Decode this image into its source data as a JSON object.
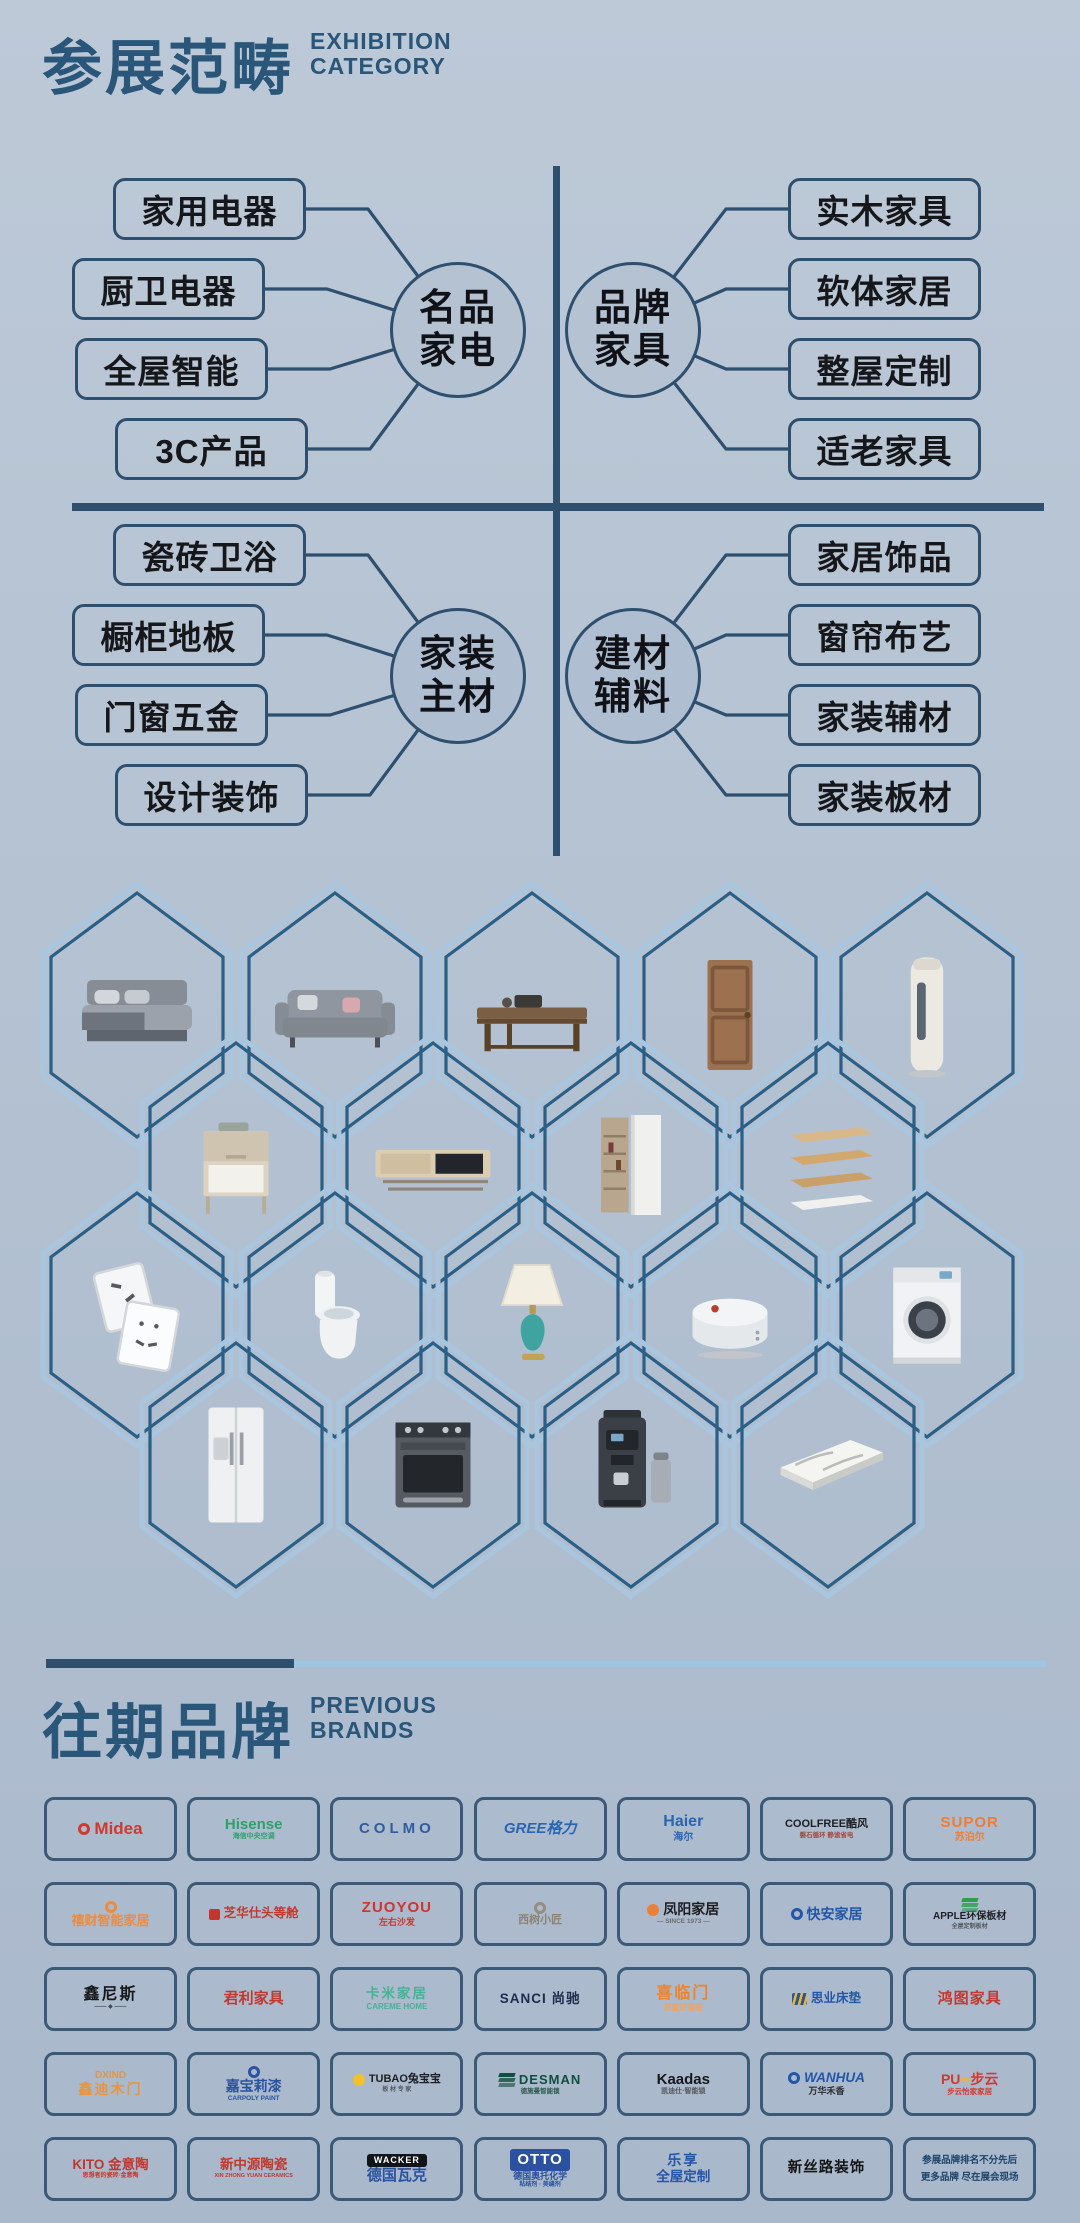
{
  "theme": {
    "accent_title": "#2a567a",
    "accent_line": "#2e4f6e",
    "hex_border_outer": "#a9c6de",
    "hex_border_inner": "#2a5f87",
    "divider_light": "#9fc6e0"
  },
  "header": {
    "title_cn": "参展范畴",
    "title_en_line1": "EXHIBITION",
    "title_en_line2": "CATEGORY"
  },
  "category_map": {
    "quadrants": [
      {
        "circle_line1": "名品",
        "circle_line2": "家电",
        "items": [
          "家用电器",
          "厨卫电器",
          "全屋智能",
          "3C产品"
        ]
      },
      {
        "circle_line1": "品牌",
        "circle_line2": "家具",
        "items": [
          "实木家具",
          "软体家居",
          "整屋定制",
          "适老家具"
        ]
      },
      {
        "circle_line1": "家装",
        "circle_line2": "主材",
        "items": [
          "瓷砖卫浴",
          "橱柜地板",
          "门窗五金",
          "设计装饰"
        ]
      },
      {
        "circle_line1": "建材",
        "circle_line2": "辅料",
        "items": [
          "家居饰品",
          "窗帘布艺",
          "家装辅材",
          "家装板材"
        ]
      }
    ]
  },
  "hex_products": {
    "rows": [
      [
        "bed",
        "sofa",
        "coffee-table",
        "wooden-door",
        "floor-ac"
      ],
      [
        "nightstand",
        "tv-cabinet",
        "wardrobe",
        "wall-shelves"
      ],
      [
        "switch-sockets",
        "toilet",
        "table-lamp",
        "robot-vacuum",
        "washing-machine"
      ],
      [
        "refrigerator",
        "oven",
        "coffee-machine",
        "stone-slab"
      ]
    ]
  },
  "brands_header": {
    "title_cn": "往期品牌",
    "title_en_line1": "PREVIOUS",
    "title_en_line2": "BRANDS"
  },
  "brands": {
    "rows": [
      [
        {
          "n": "brand-midea",
          "main": "Midea",
          "mc": "#cf3a30",
          "ms": 17,
          "mark": {
            "shape": "ring",
            "color": "#cf3a30"
          }
        },
        {
          "n": "brand-hisense",
          "main": "Hisense",
          "mc": "#2ea06b",
          "ms": 15,
          "sub": "海信中央空调",
          "sc": "#2ea06b",
          "ss": 7
        },
        {
          "n": "brand-colmo",
          "main": "COLMO",
          "mc": "#2f5d9e",
          "ms": 15,
          "sp": 4
        },
        {
          "n": "brand-gree",
          "main": "GREE格力",
          "mc": "#2a66b0",
          "ms": 15,
          "it": true
        },
        {
          "n": "brand-haier",
          "main": "Haier",
          "mc": "#2a66b0",
          "ms": 16,
          "sub": "海尔",
          "sc": "#2a66b0",
          "ss": 10
        },
        {
          "n": "brand-coolfree",
          "main": "COOLFREE酷风",
          "mc": "#1d1f24",
          "ms": 11,
          "sub": "磐石循环 静谧省电",
          "sc": "#a04a42",
          "ss": 6.5
        },
        {
          "n": "brand-supor",
          "main": "SUPOR",
          "mc": "#f07c32",
          "ms": 15,
          "sp": 1,
          "sub": "苏泊尔",
          "sc": "#f07c32",
          "ss": 10
        }
      ],
      [
        {
          "n": "brand-xicai",
          "main": "禧财智能家居",
          "mc": "#f08a3c",
          "ms": 13,
          "mark": {
            "shape": "ring",
            "color": "#f08a3c",
            "pos": "top"
          }
        },
        {
          "n": "brand-zhihuashi",
          "main": "芝华仕头等舱",
          "mc": "#bf3a30",
          "ms": 12.5,
          "mark": {
            "shape": "square",
            "color": "#c4352f"
          }
        },
        {
          "n": "brand-zuoyou",
          "main": "ZUOYOU",
          "mc": "#d0342c",
          "ms": 15,
          "sp": 1,
          "sub": "左右沙发",
          "sc": "#d0342c",
          "ss": 9
        },
        {
          "n": "brand-xishuxiaojiang",
          "main": "西树小匠",
          "mc": "#8b8475",
          "ms": 11,
          "mark": {
            "shape": "ring",
            "color": "#958d7f",
            "pos": "top"
          }
        },
        {
          "n": "brand-fengyang",
          "main": "凤阳家居",
          "mc": "#1d1d1f",
          "ms": 14,
          "mark": {
            "shape": "blob",
            "color": "#e8823a"
          },
          "sub": "— SINCE 1973 —",
          "sc": "#6b6b6b",
          "ss": 6.5
        },
        {
          "n": "brand-kuaian",
          "main": "快安家居",
          "mc": "#2456a8",
          "ms": 14,
          "mark": {
            "shape": "ring",
            "color": "#2456a8"
          }
        },
        {
          "n": "brand-apple-bancai",
          "main": "APPLE环保板材",
          "mc": "#1d1f24",
          "ms": 10,
          "mark": {
            "shape": "planks",
            "color": "#2e9e4f",
            "pos": "top"
          },
          "sub": "全屋定制板材",
          "sc": "#55585e",
          "ss": 6
        }
      ],
      [
        {
          "n": "brand-xinnisi",
          "main": "鑫尼斯",
          "mc": "#17181c",
          "ms": 16,
          "sp": 2,
          "sub": "—— ◆ ——",
          "sc": "#44474d",
          "ss": 6
        },
        {
          "n": "brand-junli",
          "main": "君利家具",
          "mc": "#c03a32",
          "ms": 15
        },
        {
          "n": "brand-kami",
          "main": "卡米家居",
          "mc": "#45b395",
          "ms": 13.5,
          "sp": 2,
          "sub": "CAREME HOME",
          "sc": "#45b395",
          "ss": 8
        },
        {
          "n": "brand-sanci",
          "main": "SANCI 尚驰",
          "mc": "#1f2c4d",
          "ms": 13.5,
          "sp": 1
        },
        {
          "n": "brand-xilinmen",
          "main": "喜临门",
          "mc": "#ef8329",
          "ms": 16,
          "sp": 2,
          "sub": "深度好睡眠",
          "sc": "#f2a45f",
          "ss": 8
        },
        {
          "n": "brand-siye",
          "main": "思业床垫",
          "mc": "#2456a8",
          "ms": 12.5,
          "mark": {
            "shape": "stripes",
            "color": "#2456a8"
          }
        },
        {
          "n": "brand-hongtu",
          "main": "鸿图家具",
          "mc": "#c03a32",
          "ms": 15,
          "sp": 1
        }
      ],
      [
        {
          "n": "brand-dxind",
          "top": "DXIND",
          "tc": "#e8953c",
          "ts": 10,
          "main": "鑫迪木门",
          "mc": "#e8953c",
          "ms": 14,
          "sp": 2
        },
        {
          "n": "brand-carpoly",
          "main": "嘉宝莉漆",
          "mc": "#2a52a0",
          "ms": 14,
          "mark": {
            "shape": "ring",
            "color": "#2a52a0",
            "pos": "top"
          },
          "sub": "CARPOLY PAINT",
          "sc": "#2a52a0",
          "ss": 6.5
        },
        {
          "n": "brand-tubao",
          "main": "TUBAO兔宝宝",
          "mc": "#1d1f24",
          "ms": 11,
          "mark": {
            "shape": "blob",
            "color": "#f2c12e"
          },
          "sub": "板 材 专 家",
          "sc": "#55585e",
          "ss": 6
        },
        {
          "n": "brand-desman",
          "main": "DESMAN",
          "mc": "#0e4f3e",
          "ms": 13,
          "sp": 1,
          "mark": {
            "shape": "planks",
            "color": "#0e4f3e"
          },
          "sub": "德施曼智能锁",
          "sc": "#2f5a4e",
          "ss": 6.5
        },
        {
          "n": "brand-kaadas",
          "main": "Kaadas",
          "mc": "#17181c",
          "ms": 15,
          "sub": "凯迪仕·智能锁",
          "sc": "#55585e",
          "ss": 7
        },
        {
          "n": "brand-wanhua",
          "main": "WANHUA",
          "mc": "#2456a8",
          "ms": 13.5,
          "it": true,
          "mark": {
            "shape": "ring",
            "color": "#2456a8"
          },
          "sub": "万华禾香",
          "sc": "#2b2d33",
          "ss": 9
        },
        {
          "n": "brand-puyun",
          "seg": [
            {
              "t": "PU",
              "c": "#d03a30"
            },
            {
              "t": "∞",
              "c": "#f0b42a"
            },
            {
              "t": "步云",
              "c": "#d03a30"
            }
          ],
          "ms": 14,
          "sub": "步云怡家家居",
          "sc": "#d03a30",
          "ss": 7.5
        }
      ],
      [
        {
          "n": "brand-kito",
          "main": "KITO 金意陶",
          "mc": "#c0392f",
          "ms": 13.5,
          "sub": "思想者的瓷砖·金意陶",
          "sc": "#c0392f",
          "ss": 6
        },
        {
          "n": "brand-xinzhongyuan",
          "main": "新中源陶瓷",
          "mc": "#c0392f",
          "ms": 13.5,
          "sub": "XIN ZHONG YUAN CERAMICS",
          "sc": "#c0392f",
          "ss": 5.5
        },
        {
          "n": "brand-wacker",
          "main": "德国瓦克",
          "mc": "#2a52a0",
          "ms": 15,
          "mark": {
            "shape": "badge",
            "text": "WACKER",
            "bg": "#111418",
            "fg": "#ffffff",
            "size": 9,
            "pos": "top"
          }
        },
        {
          "n": "brand-otto",
          "main": "德国奥托化学",
          "mc": "#2a52a0",
          "ms": 9,
          "mark": {
            "shape": "badge",
            "text": "OTTO",
            "bg": "#2a52a0",
            "fg": "#ffffff",
            "size": 15,
            "pos": "top"
          },
          "sub": "粘结剂 · 美缝剂",
          "sc": "#2a52a0",
          "ss": 6
        },
        {
          "n": "brand-lexiang",
          "main": "乐享",
          "mc": "#2456a8",
          "ms": 14,
          "sp": 2,
          "sub": "全屋定制",
          "sc": "#2456a8",
          "ss": 13.5
        },
        {
          "n": "brand-xinsilu",
          "main": "新丝路装饰",
          "mc": "#141414",
          "ms": 14.5,
          "sp": 1
        },
        {
          "n": "brand-footnote",
          "lines": [
            "参展品牌排名不分先后",
            "更多品牌 尽在展会现场"
          ]
        }
      ]
    ]
  }
}
